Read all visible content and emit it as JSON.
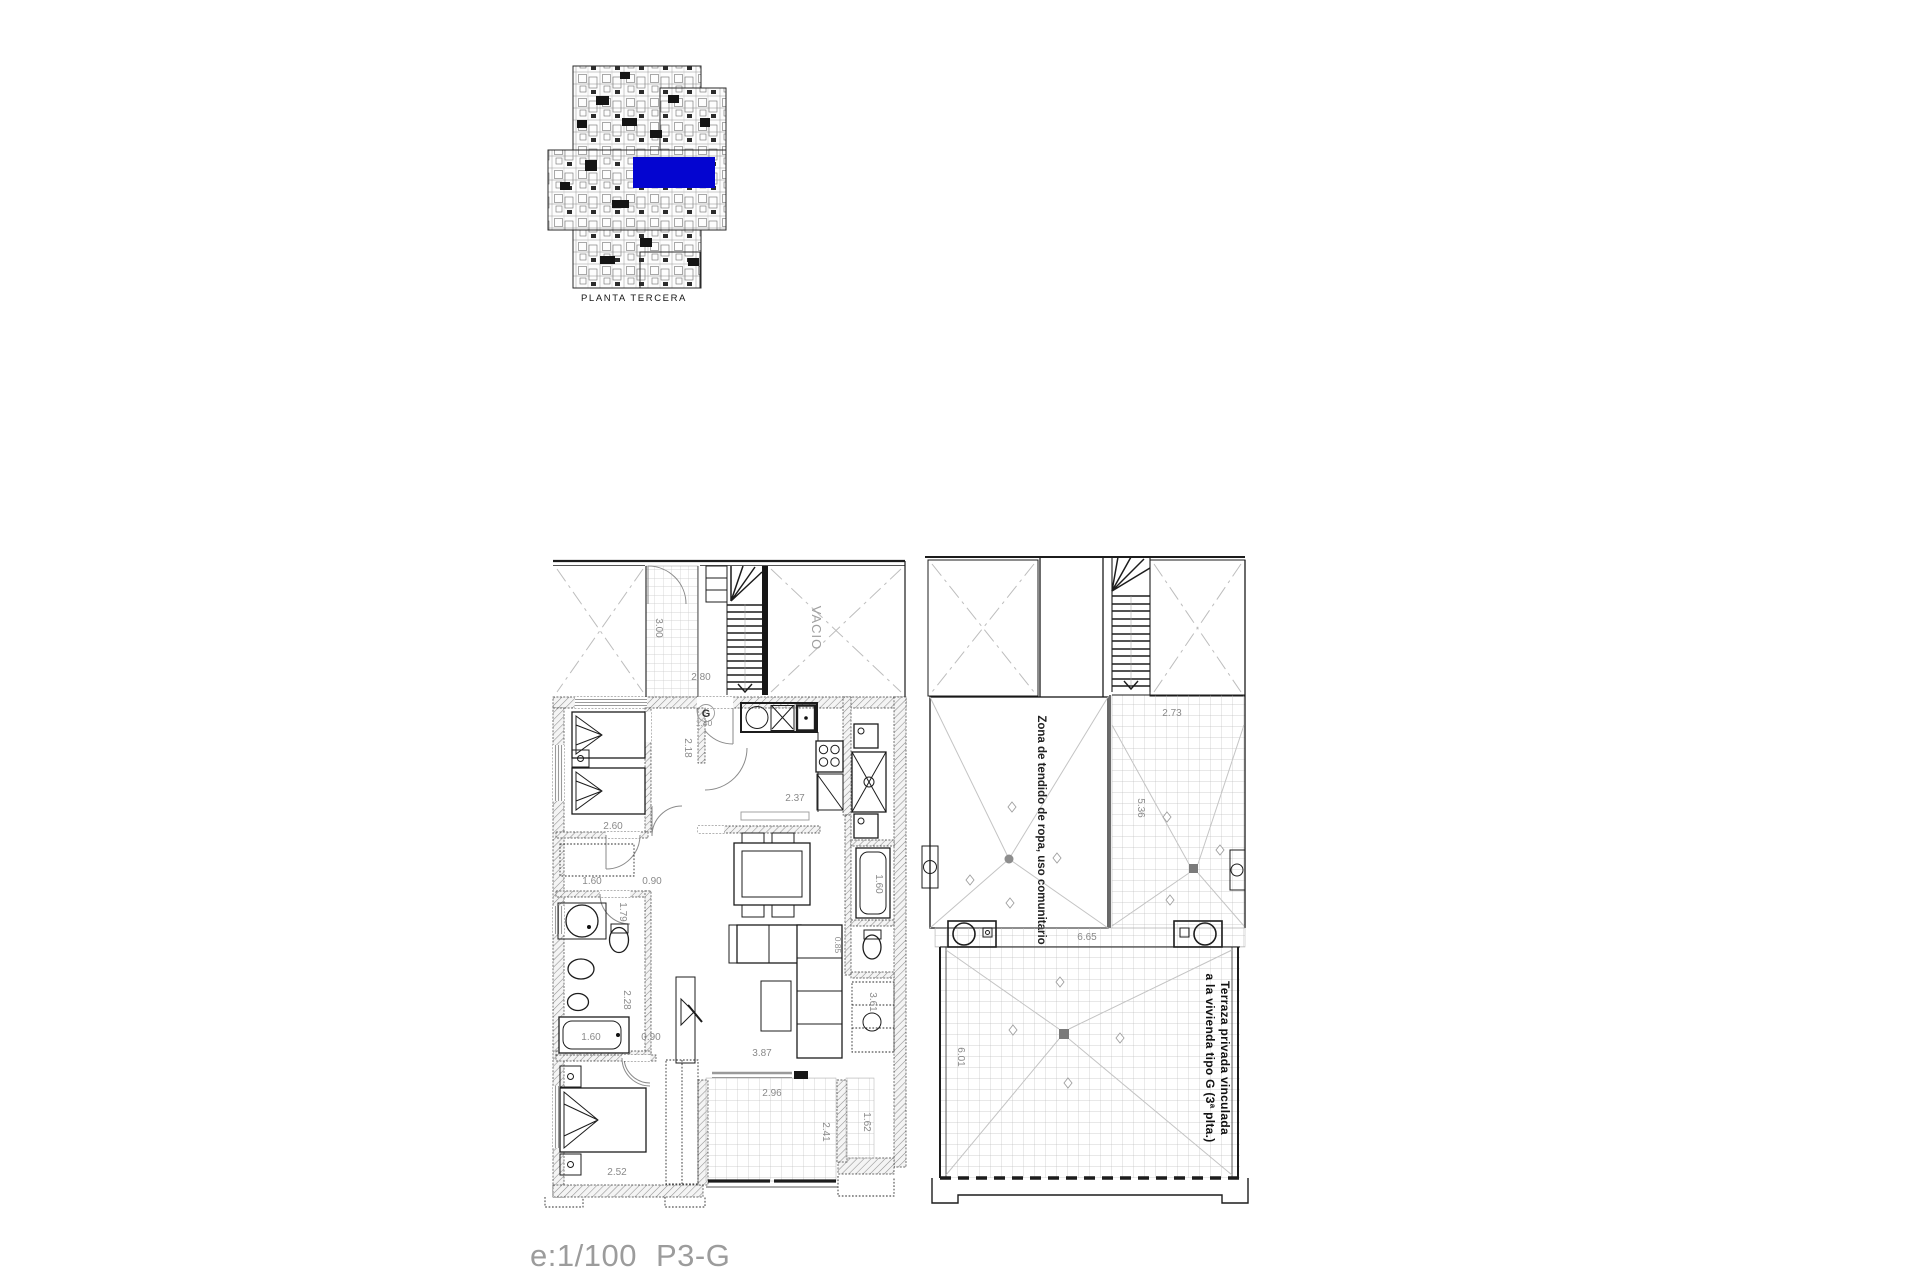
{
  "document": {
    "background": "#ffffff",
    "ink_color": "#1c1c1c",
    "dim_color": "#8a8a8a",
    "scale_label": "e:1/100",
    "sheet_code": "P3-G"
  },
  "overview": {
    "caption": "PLANTA TERCERA",
    "highlight_color": "#0405d0"
  },
  "left_plan": {
    "void_label": "VACIO",
    "entry_label": "G",
    "dims": {
      "patio_depth": "3.00",
      "balcony_width": "2.80",
      "entry_width": "1.40",
      "hall_depth": "2.18",
      "kitchen_width": "2.37",
      "bedroom1_width": "2.60",
      "closet_width": "1.60",
      "lobby_width": "0.90",
      "bath_depth": "1.79",
      "bath_inner_depth": "2.28",
      "bathtub_length": "1.60",
      "bath_width": "0.90",
      "living_length": "3.87",
      "bedroom2_width": "2.52",
      "terrace_width": "2.96",
      "terrace_depth": "2.41",
      "side_terrace_depth": "1.62",
      "wardrobe_length": "3.61",
      "bathtub2_length": "1.60",
      "sofa_depth": "0.85"
    }
  },
  "right_plan": {
    "drying_zone_label": "Zona de tendido de ropa, uso comunitario",
    "terrace_label_line1": "Terraza privada vinculada",
    "terrace_label_line2": "a la vivienda tipo G (3ª plta.)",
    "dims": {
      "upper_terrace_width": "2.73",
      "upper_terrace_depth": "5.36",
      "terrace_width": "6.65",
      "terrace_depth": "6.01"
    }
  }
}
